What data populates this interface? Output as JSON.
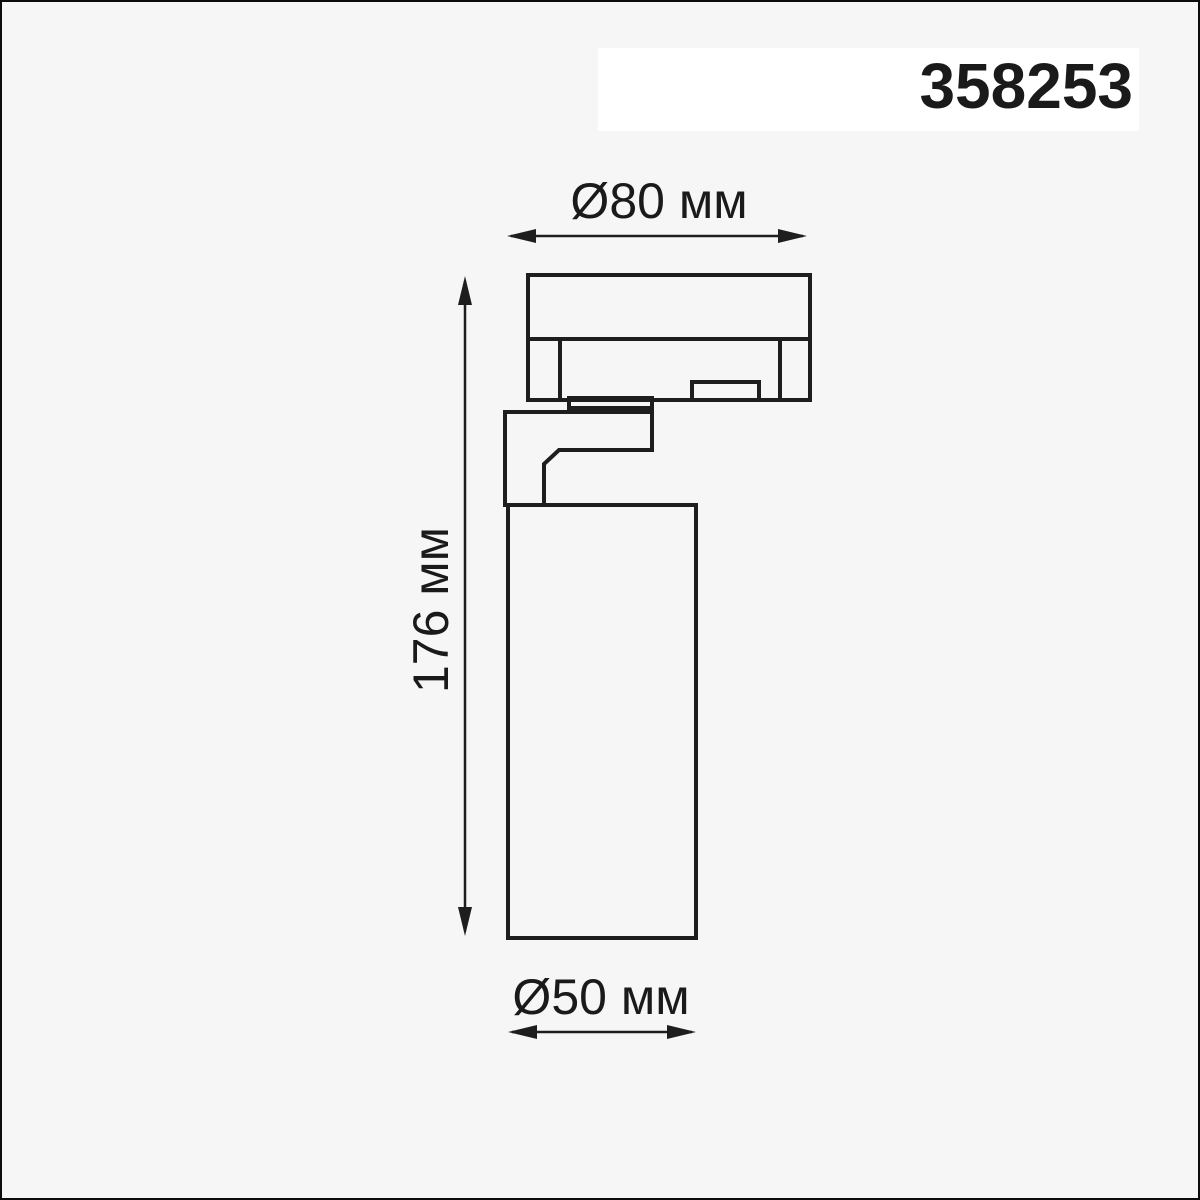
{
  "page": {
    "background_color": "#f6f6f6",
    "frame_color": "#0d0d0d",
    "line_color": "#1e1e1e",
    "label_box_color": "#ffffff",
    "text_color": "#1a1a1a"
  },
  "label": {
    "code": "358253"
  },
  "dimensions": {
    "top_diameter": {
      "text": "Ø80 мм",
      "value_mm": 80
    },
    "height": {
      "text": "176 мм",
      "value_mm": 176
    },
    "bottom_diameter": {
      "text": "Ø50 мм",
      "value_mm": 50
    }
  }
}
